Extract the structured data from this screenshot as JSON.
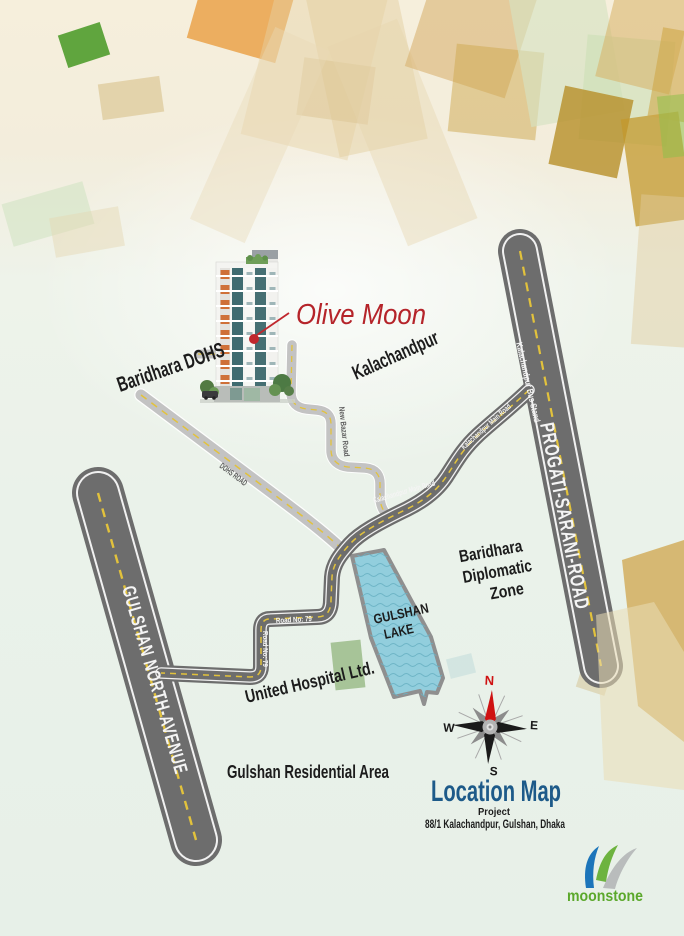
{
  "palette": {
    "accent_red": "#b5242a",
    "title_blue": "#1d5a89",
    "brand_green": "#5ba82b",
    "lake_blue": "#92cedd",
    "road_dark": "#6d6d6d",
    "road_light": "#c3c3c3",
    "dash_yellow": "#e2c23c",
    "compass_north_red": "#cf1212"
  },
  "project": {
    "name": "Olive Moon",
    "area_label": "Kalachandpur"
  },
  "map": {
    "labels": {
      "baridhara_dohs": "Baridhara DOHS",
      "dohs_road": "DOHS ROAD",
      "new_bazar_road": "New Bazar Road",
      "kalachandpur_bus_stand": "Kalachandpur Bus Stand",
      "kalachandpur_main_road": "Kalachandpur Main Road",
      "progati_sarani_road": "PROGATI-SARANI-ROAD",
      "gulshan_north_avenue": "GULSHAN NORTH-AVENUE",
      "road_no_79": "Road No: 79",
      "united_hospital": "United Hospital Ltd.",
      "gulshan_residential_area": "Gulshan Residential Area"
    },
    "lake_label": [
      "GULSHAN",
      "LAKE"
    ],
    "diplomatic_zone": [
      "Baridhara",
      "Diplomatic",
      "Zone"
    ]
  },
  "compass": {
    "north": "N",
    "east": "E",
    "west": "W",
    "south": "S"
  },
  "title_block": {
    "title": "Location Map",
    "subtitle": "Project",
    "address": "88/1 Kalachandpur, Gulshan, Dhaka"
  },
  "logo": {
    "brand": "moonstone"
  }
}
